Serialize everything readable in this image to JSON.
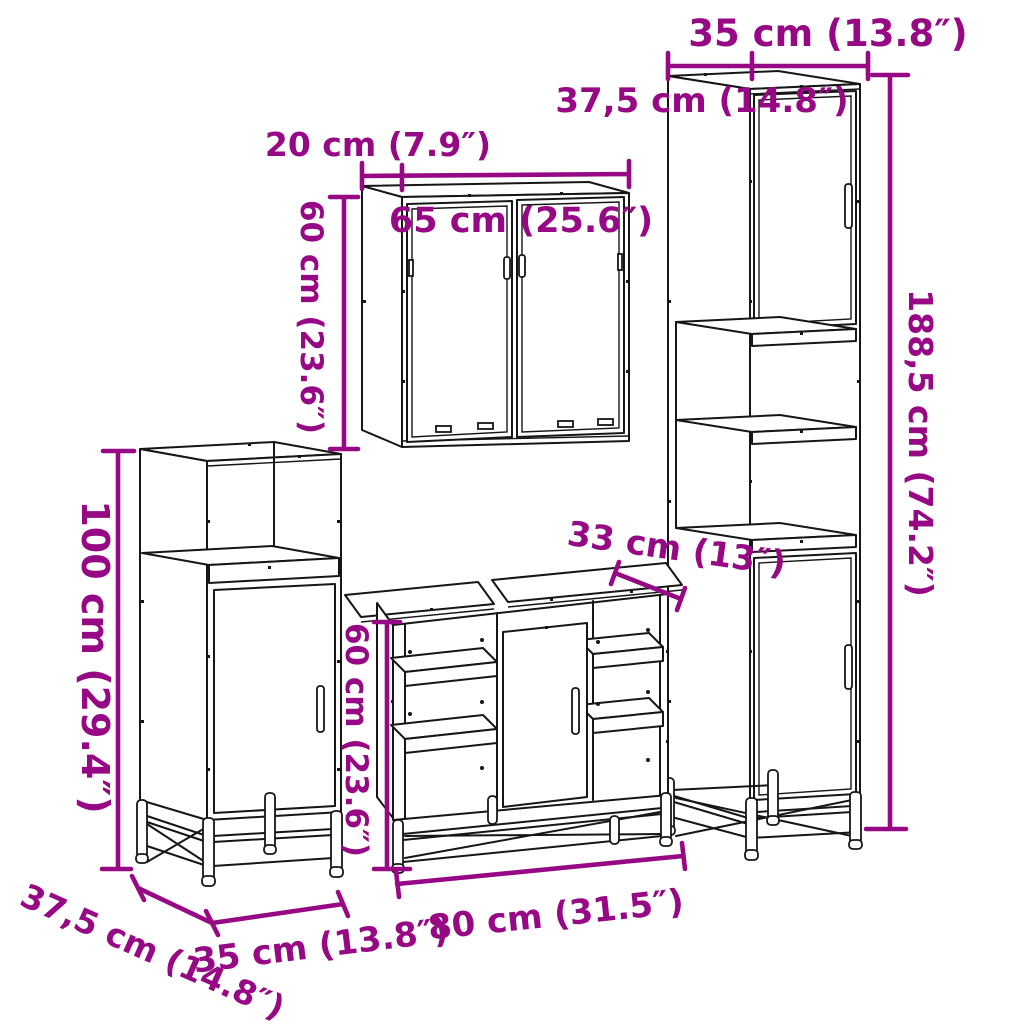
{
  "diagram": {
    "title": "4-piece bathroom furniture set dimension drawing",
    "colors": {
      "dimension_text": "#970984",
      "line_art": "#161616",
      "background": "#ffffff"
    },
    "tall_cabinet": {
      "width": "35 cm (13.8″)",
      "depth": "37,5 cm (14.8″)",
      "height": "188,5 cm (74.2″)"
    },
    "mirror_cabinet": {
      "depth": "20 cm (7.9″)",
      "width": "65 cm (25.6″)",
      "height": "60 cm (23.6″)"
    },
    "side_cabinet": {
      "height": "100 cm (29.4″)",
      "depth": "37,5 cm (14.8″)",
      "width": "35 cm (13.8″)"
    },
    "vanity": {
      "depth": "33 cm (13″)",
      "height": "60 cm (23.6″)",
      "width": "80 cm (31.5″)"
    }
  }
}
